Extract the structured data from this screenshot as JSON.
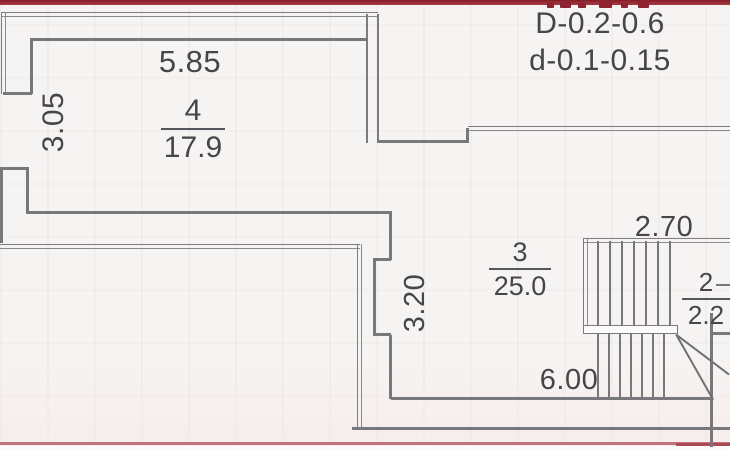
{
  "plan": {
    "legend": {
      "line1": "D-0.2-0.6",
      "line2": "d-0.1-0.15"
    },
    "rooms": {
      "r4": {
        "number": "4",
        "area": "17.9"
      },
      "r3": {
        "number": "3",
        "area": "25.0"
      },
      "r2": {
        "number": "2",
        "area": "2.2"
      }
    },
    "dims": {
      "top_width": "5.85",
      "left_height": "3.05",
      "mid_height": "3.20",
      "stair_width": "2.70",
      "bottom_width": "6.00"
    },
    "colors": {
      "wall": "#77777c",
      "text": "#45454a",
      "red_band": "#9b2531",
      "red_line": "#c5737b",
      "background": "#f6f4f2"
    }
  }
}
